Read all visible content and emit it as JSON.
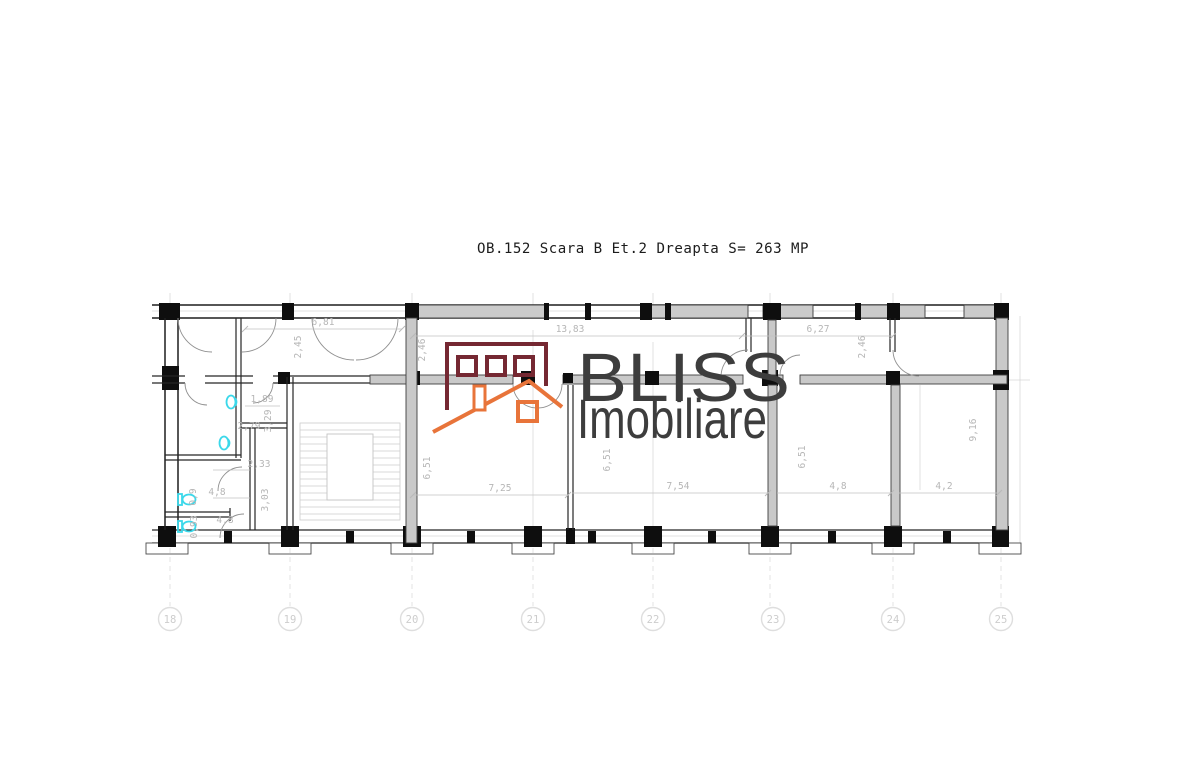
{
  "title": "OB.152 Scara B Et.2 Dreapta  S= 263 MP",
  "watermark": {
    "brand_top": "BLISS",
    "brand_bottom": "Imobiliare",
    "logo_maroon": "#752832",
    "logo_orange": "#e8743a",
    "text_color": "#3d3d3d"
  },
  "grid": {
    "labels": [
      "18",
      "19",
      "20",
      "21",
      "22",
      "23",
      "24",
      "25"
    ]
  },
  "dims": {
    "d_681": "6,81",
    "d_1383": "13,83",
    "d_627": "6,27",
    "d_725": "7,25",
    "d_754": "7,54",
    "d_48": "4,8",
    "d_42": "4,2",
    "d_245": "2,45",
    "d_246a": "2,46",
    "d_246b": "2,46",
    "d_651a": "6,51",
    "d_651b": "6,51",
    "d_651c": "6,51",
    "d_916": "9,16",
    "d_189": "1,89",
    "d_279": "2,79",
    "d_233": "2,33",
    "d_48a": "4,8",
    "d_48b": "4,8",
    "d_09": "0,9",
    "d_093": "0,93",
    "d_329": "3,29",
    "d_303": "3,03"
  },
  "fixtures": {
    "color": "#3bd8ea",
    "items": [
      "sink",
      "sink",
      "toilet",
      "toilet"
    ]
  }
}
